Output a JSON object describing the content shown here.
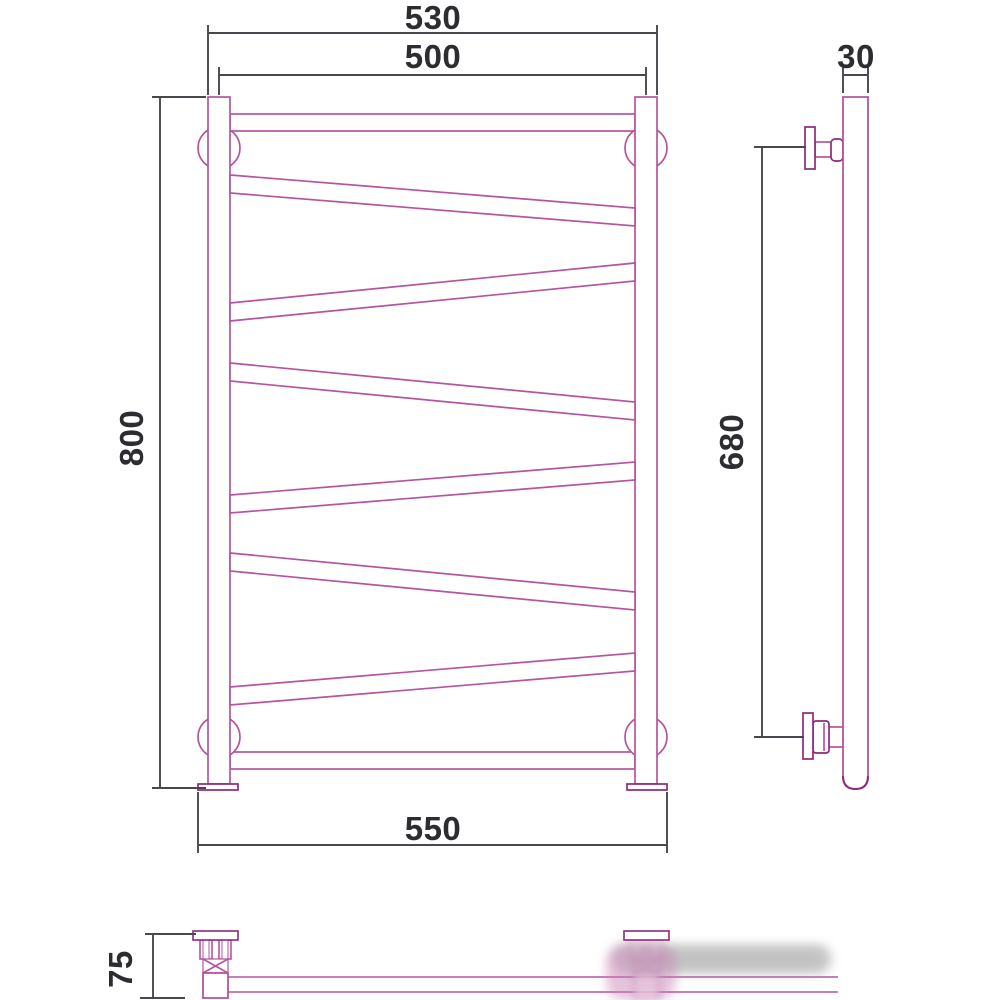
{
  "drawing": {
    "dimensions": {
      "front_top_outer_width_mm": "530",
      "front_center_width_mm": "500",
      "front_height_mm": "800",
      "front_bottom_width_mm": "550",
      "side_mount_span_mm": "680",
      "side_tube_width_mm": "30",
      "bottom_wall_offset_mm": "75"
    },
    "colors": {
      "outline_pink": "#b5559d",
      "outline_dark_pink": "#8f2878",
      "dimension_line": "#47474d",
      "dimension_text": "#2c2c31",
      "background": "#ffffff",
      "watermark_gray": "#a0a0a0"
    }
  }
}
